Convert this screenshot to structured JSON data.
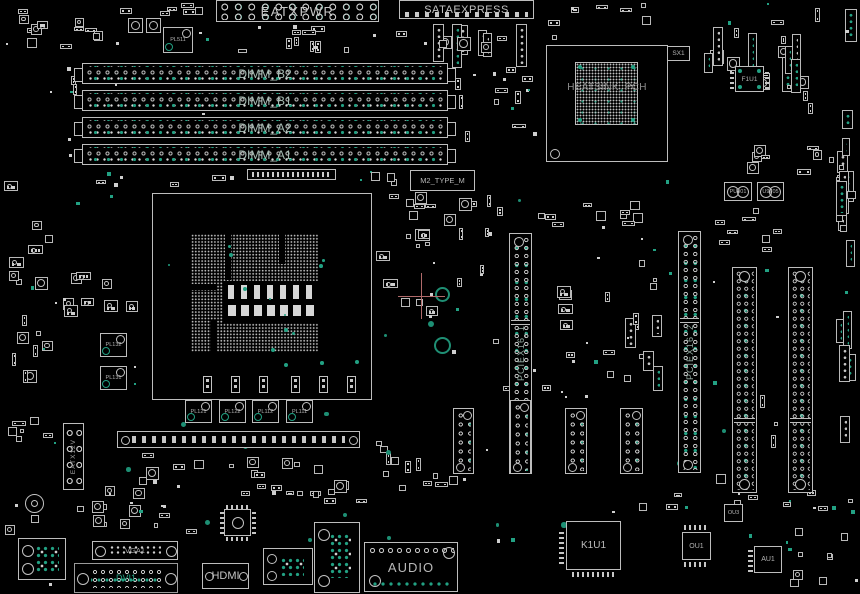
{
  "colors": {
    "background": "#000000",
    "outline": "#bfbfbf",
    "pad_white": "#d2d2d2",
    "pad_teal": "#22a183",
    "label_gray": "#b3b3b3",
    "slot_label": "#93aaa1",
    "crosshair_pink": "#b06a6a"
  },
  "connectors": {
    "eatxpwr": "EATXPWR",
    "sataexpress": "SATAEXPRESS",
    "eatx12v": "EATX12V",
    "m2_slot": "M2_TYPE_M",
    "hdmi": "HDMI",
    "audio": "AUDIO",
    "vga": "VGA1",
    "dvi": "DVI1"
  },
  "memory": {
    "dimm_slots": [
      {
        "label": "DIMM_B2"
      },
      {
        "label": "DIMM_B1"
      },
      {
        "label": "DIMM_A2"
      },
      {
        "label": "DIMM_A1"
      }
    ]
  },
  "expansion": {
    "pcie_slots": [
      {
        "label": "PCIEX16_1"
      },
      {
        "label": "PCIEX16_2"
      }
    ]
  },
  "chips": {
    "pch_heatsink": "HEATSINK_PCH",
    "sx1": "SX1",
    "f1u1": "F1U1",
    "k1u1": "K1U1",
    "ou1": "OU1",
    "ou3": "OU3",
    "au1": "AU1",
    "pu901": "PU901",
    "u9705": "U9705"
  },
  "chokes": {
    "pl511": "PL511",
    "pl132": "PL132",
    "pl131": "PL131",
    "pl121": "PL121",
    "pl122": "PL122",
    "pl112": "PL112",
    "pl111": "PL111"
  }
}
